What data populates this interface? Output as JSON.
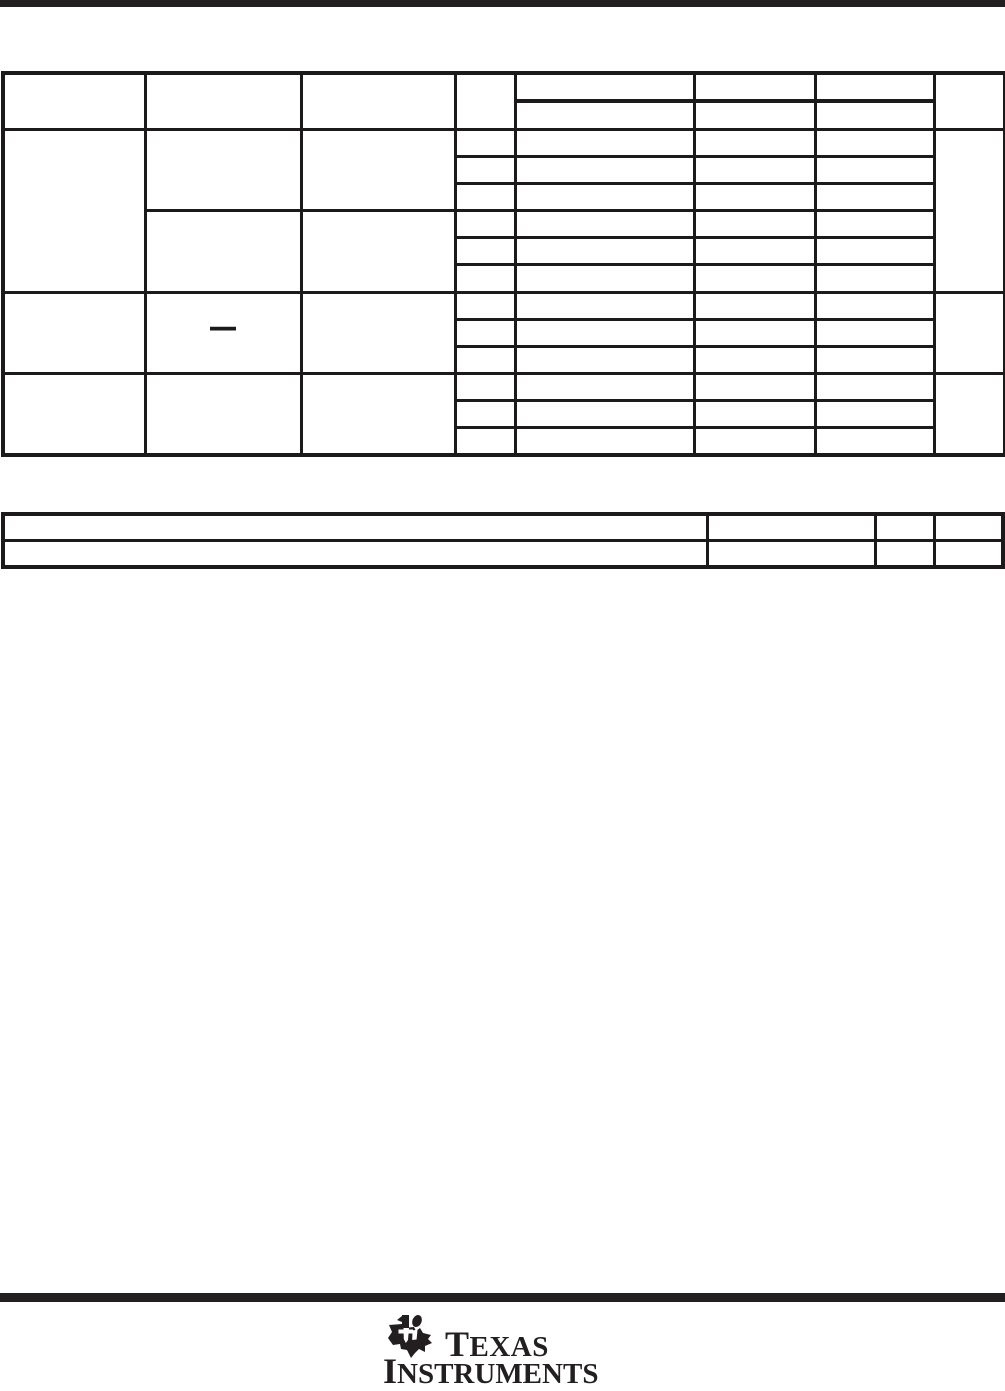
{
  "page": {
    "background": "#ffffff",
    "rule_color": "#231f20",
    "table_line_color": "#1d1a1b"
  },
  "table1": {
    "dash": "—"
  },
  "table2": {},
  "logo": {
    "line1": "TEXAS",
    "line2": "INSTRUMENTS"
  }
}
